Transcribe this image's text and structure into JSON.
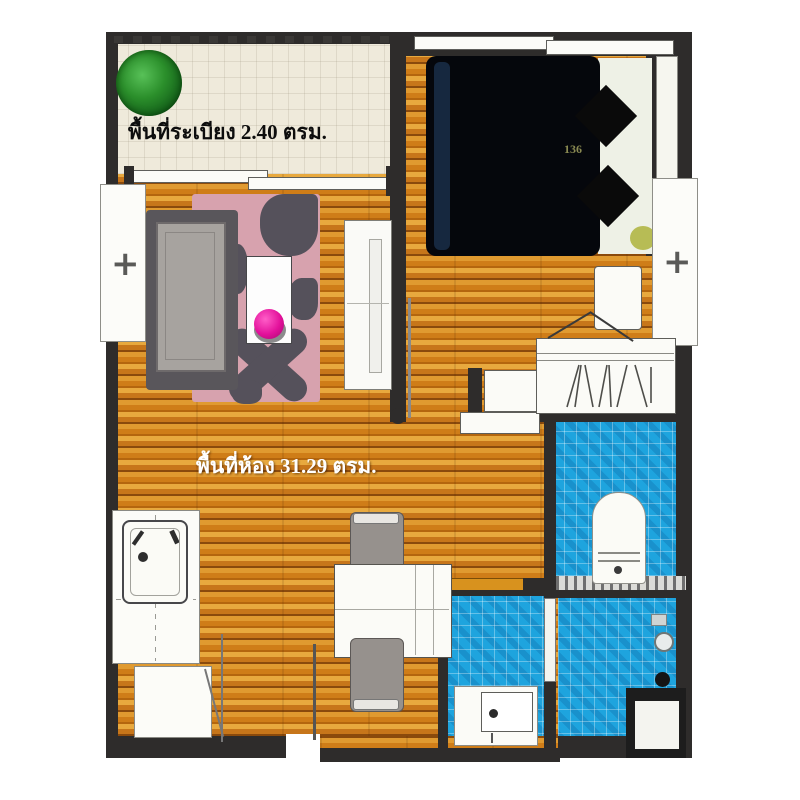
{
  "floor_plan": {
    "balcony_label": "พื้นที่ระเบียง 2.40 ตรม.",
    "room_label": "พื้นที่ห้อง 31.29 ตรม.",
    "bed_label": "136"
  },
  "colors": {
    "wall": "#2e2c2b",
    "wood_floor": "#cf7d18",
    "balcony_floor": "#efeadb",
    "bathroom_tile": "#1ea4de",
    "rug_pink": "#d7a2ae",
    "rug_patch": "#55515b",
    "accent_ball": "#e3119b",
    "plant_green": "#1e7a1e",
    "bed_dark": "#05070c"
  }
}
